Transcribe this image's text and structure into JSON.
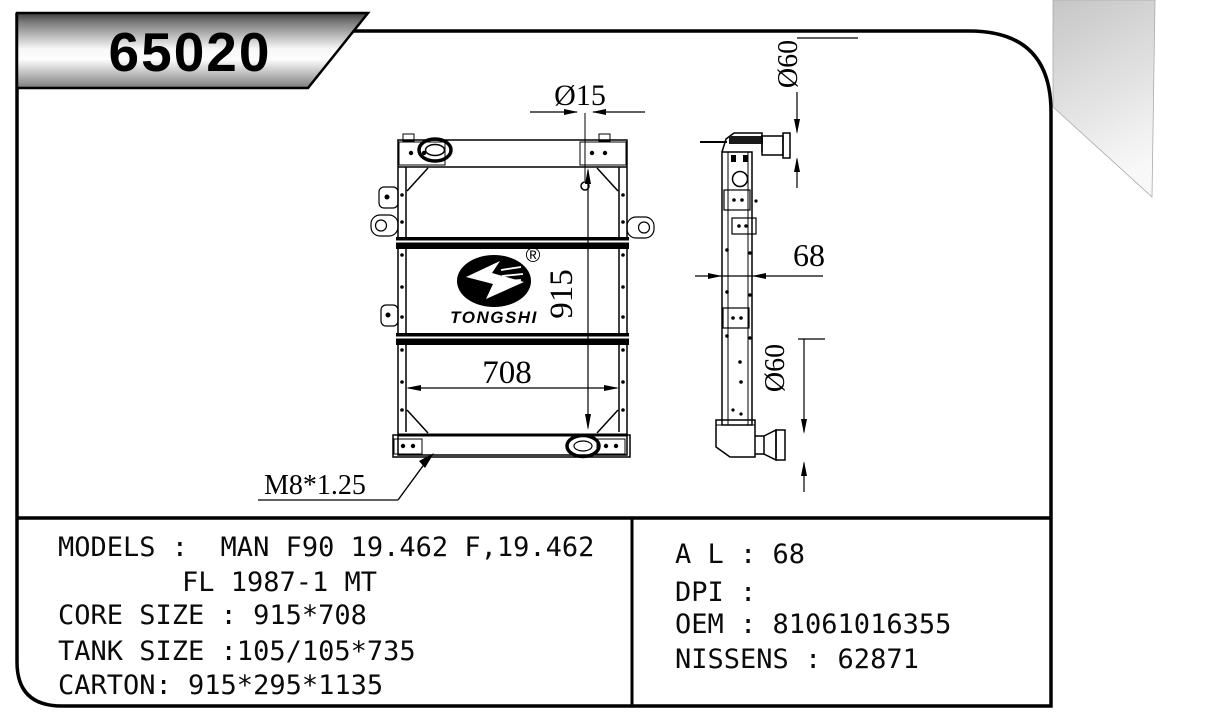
{
  "header": {
    "part_number": "65020"
  },
  "logo": {
    "name": "TONGSHI",
    "reg": "®"
  },
  "drawing": {
    "front_view": {
      "hole_diameter": "Ø15",
      "core_height": "915",
      "core_width": "708",
      "drain_thread": "M8*1.25"
    },
    "side_view": {
      "depth": "68",
      "top_pipe_diameter": "Ø60",
      "bottom_pipe_diameter": "Ø60"
    }
  },
  "spec_panel": {
    "left": {
      "line1": "MODELS :  MAN F90 19.462 F,19.462",
      "line2": "FL 1987-1 MT",
      "line3": "CORE SIZE : 915*708",
      "line4": "TANK SIZE :105/105*735",
      "line5": "CARTON: 915*295*1135"
    },
    "right": {
      "line1": "A L : 68",
      "line2": "DPI :",
      "line3": "OEM : 81061016355",
      "line4": "NISSENS : 62871"
    }
  },
  "colors": {
    "line_color": "#000000",
    "banner_gradient_top": "#3f3f3f",
    "banner_gradient_mid": "#f8f8f8",
    "banner_gradient_bottom": "#7d7d7d",
    "corner_fold_gradient_top": "#c6c6c6",
    "corner_fold_gradient_bottom": "#f8f8f8"
  }
}
